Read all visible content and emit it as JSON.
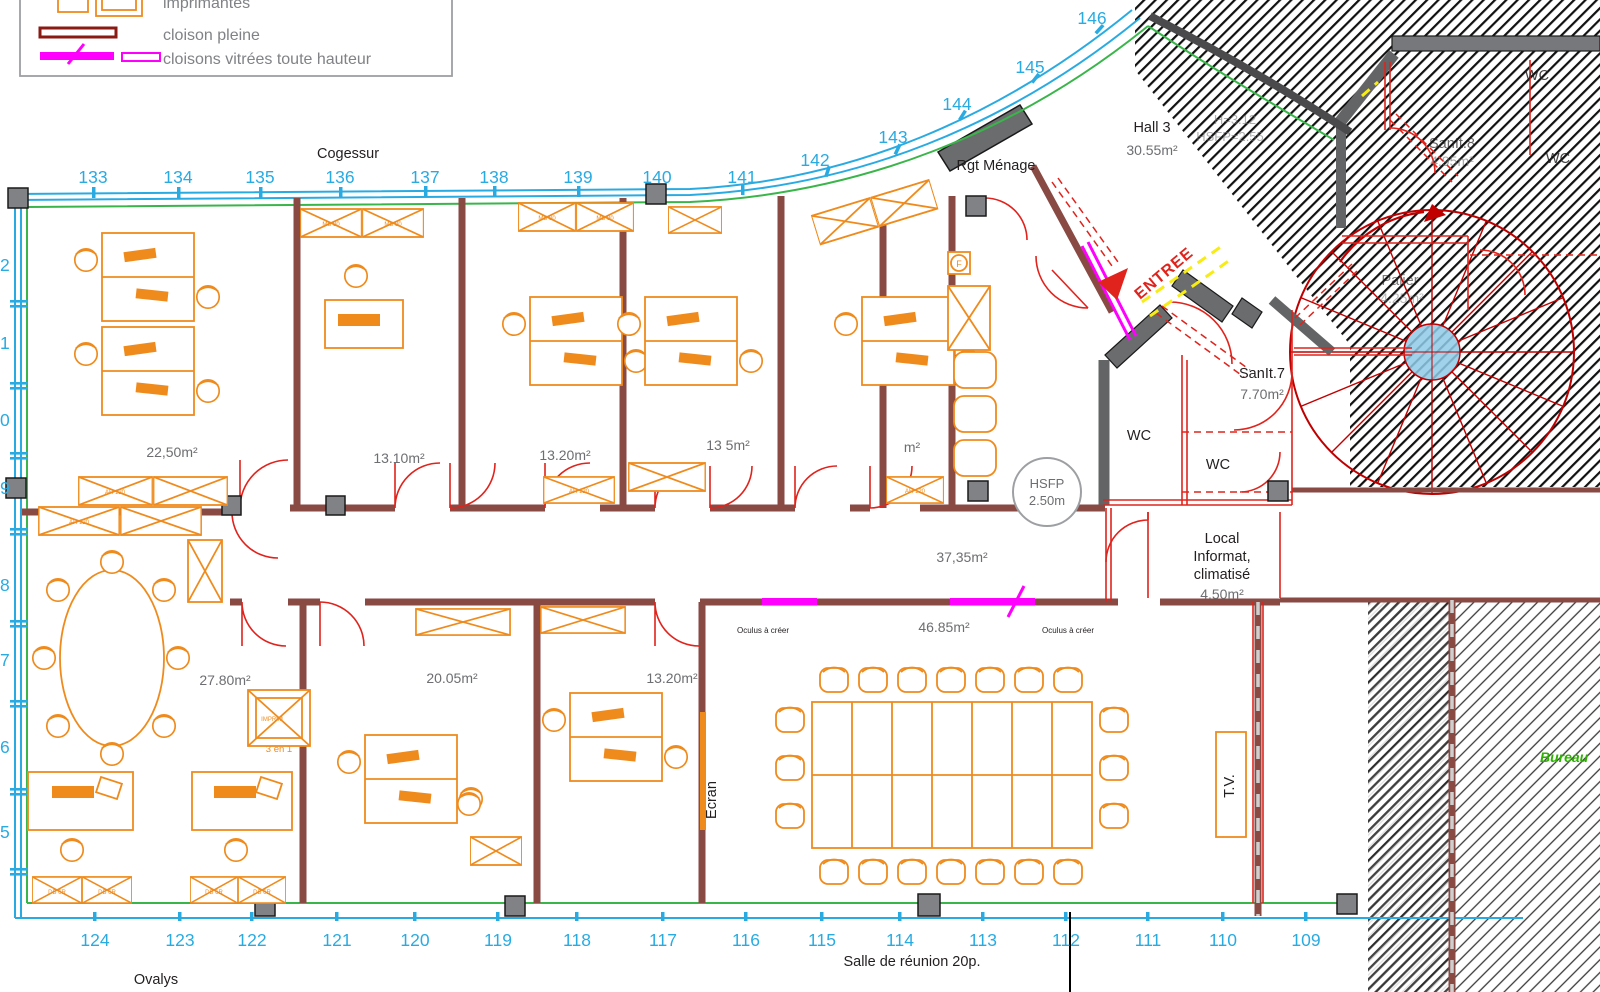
{
  "colors": {
    "cyan": "#29ABE2",
    "green": "#39B54A",
    "orange": "#EF8B1D",
    "wall_red": "#E0231C",
    "wall_maroon": "#8A4A44",
    "magenta": "#FF00FF",
    "yellow": "#F7EC13",
    "gray_wall": "#636466",
    "text_dark": "#231F20",
    "text_gray": "#6D6E71"
  },
  "legend": {
    "items": [
      "imprimantes",
      "cloison pleine",
      "cloisons vitrées toute hauteur"
    ]
  },
  "grid": {
    "top": [
      "133",
      "134",
      "135",
      "136",
      "137",
      "138",
      "139",
      "140",
      "141",
      "142",
      "143",
      "144",
      "145",
      "146"
    ],
    "bottom": [
      "124",
      "123",
      "122",
      "121",
      "120",
      "119",
      "118",
      "117",
      "116",
      "115",
      "114",
      "113",
      "112",
      "111",
      "110",
      "109"
    ],
    "left": [
      "2",
      "1",
      "0",
      "9",
      "8",
      "7",
      "6",
      "5"
    ]
  },
  "titles": {
    "top": "Cogessur",
    "bottom_left": "Ovalys",
    "bottom_center": "Salle de réunion 20p."
  },
  "rooms": {
    "office_tl": {
      "area": "22,50m²"
    },
    "office_1310": {
      "area": "13.10m²"
    },
    "office_1320a": {
      "area": "13.20m²"
    },
    "office_13x5": {
      "area": "13 5m²"
    },
    "office_part": {
      "area": "m²"
    },
    "hall3": {
      "name": "Hall 3",
      "area": "30.55m²"
    },
    "sanit7": {
      "name": "SanIt.7",
      "area": "7.70m²"
    },
    "sanit8": {
      "name": "SanIt.8",
      "area": "4.95m²"
    },
    "palier": {
      "name": "Palier",
      "area": "4.25m²"
    },
    "wc": "WC",
    "local_info": {
      "line1": "Local",
      "line2": "Informat,",
      "line3": "climatisé",
      "area": "4.50m²"
    },
    "corridor": {
      "area": "37,35m²"
    },
    "reunion": {
      "area": "46.85m²"
    },
    "office_2780": {
      "area": "27.80m²"
    },
    "office_2005": {
      "area": "20.05m²"
    },
    "office_1320b": {
      "area": "13.20m²"
    }
  },
  "annotations": {
    "rgt_menage": "Rgt Ménage",
    "entree": "ENTREE",
    "hsfp_line1": "HSFP",
    "hsfp_line2": "2.50m",
    "hatch_note1": "H=3.12",
    "hatch_note2": "HSFP=2.55",
    "oculus": "Oculus à créer",
    "ecran": "Ecran",
    "tv": "T.V.",
    "trois_en_un": "3 en 1",
    "bureau": "Bureau",
    "cab_mb": "MB 80",
    "cab_ah": "AH 120",
    "cab_db": "DB 6R",
    "imprim": "IMPRIM",
    "f_symbol": "F"
  }
}
